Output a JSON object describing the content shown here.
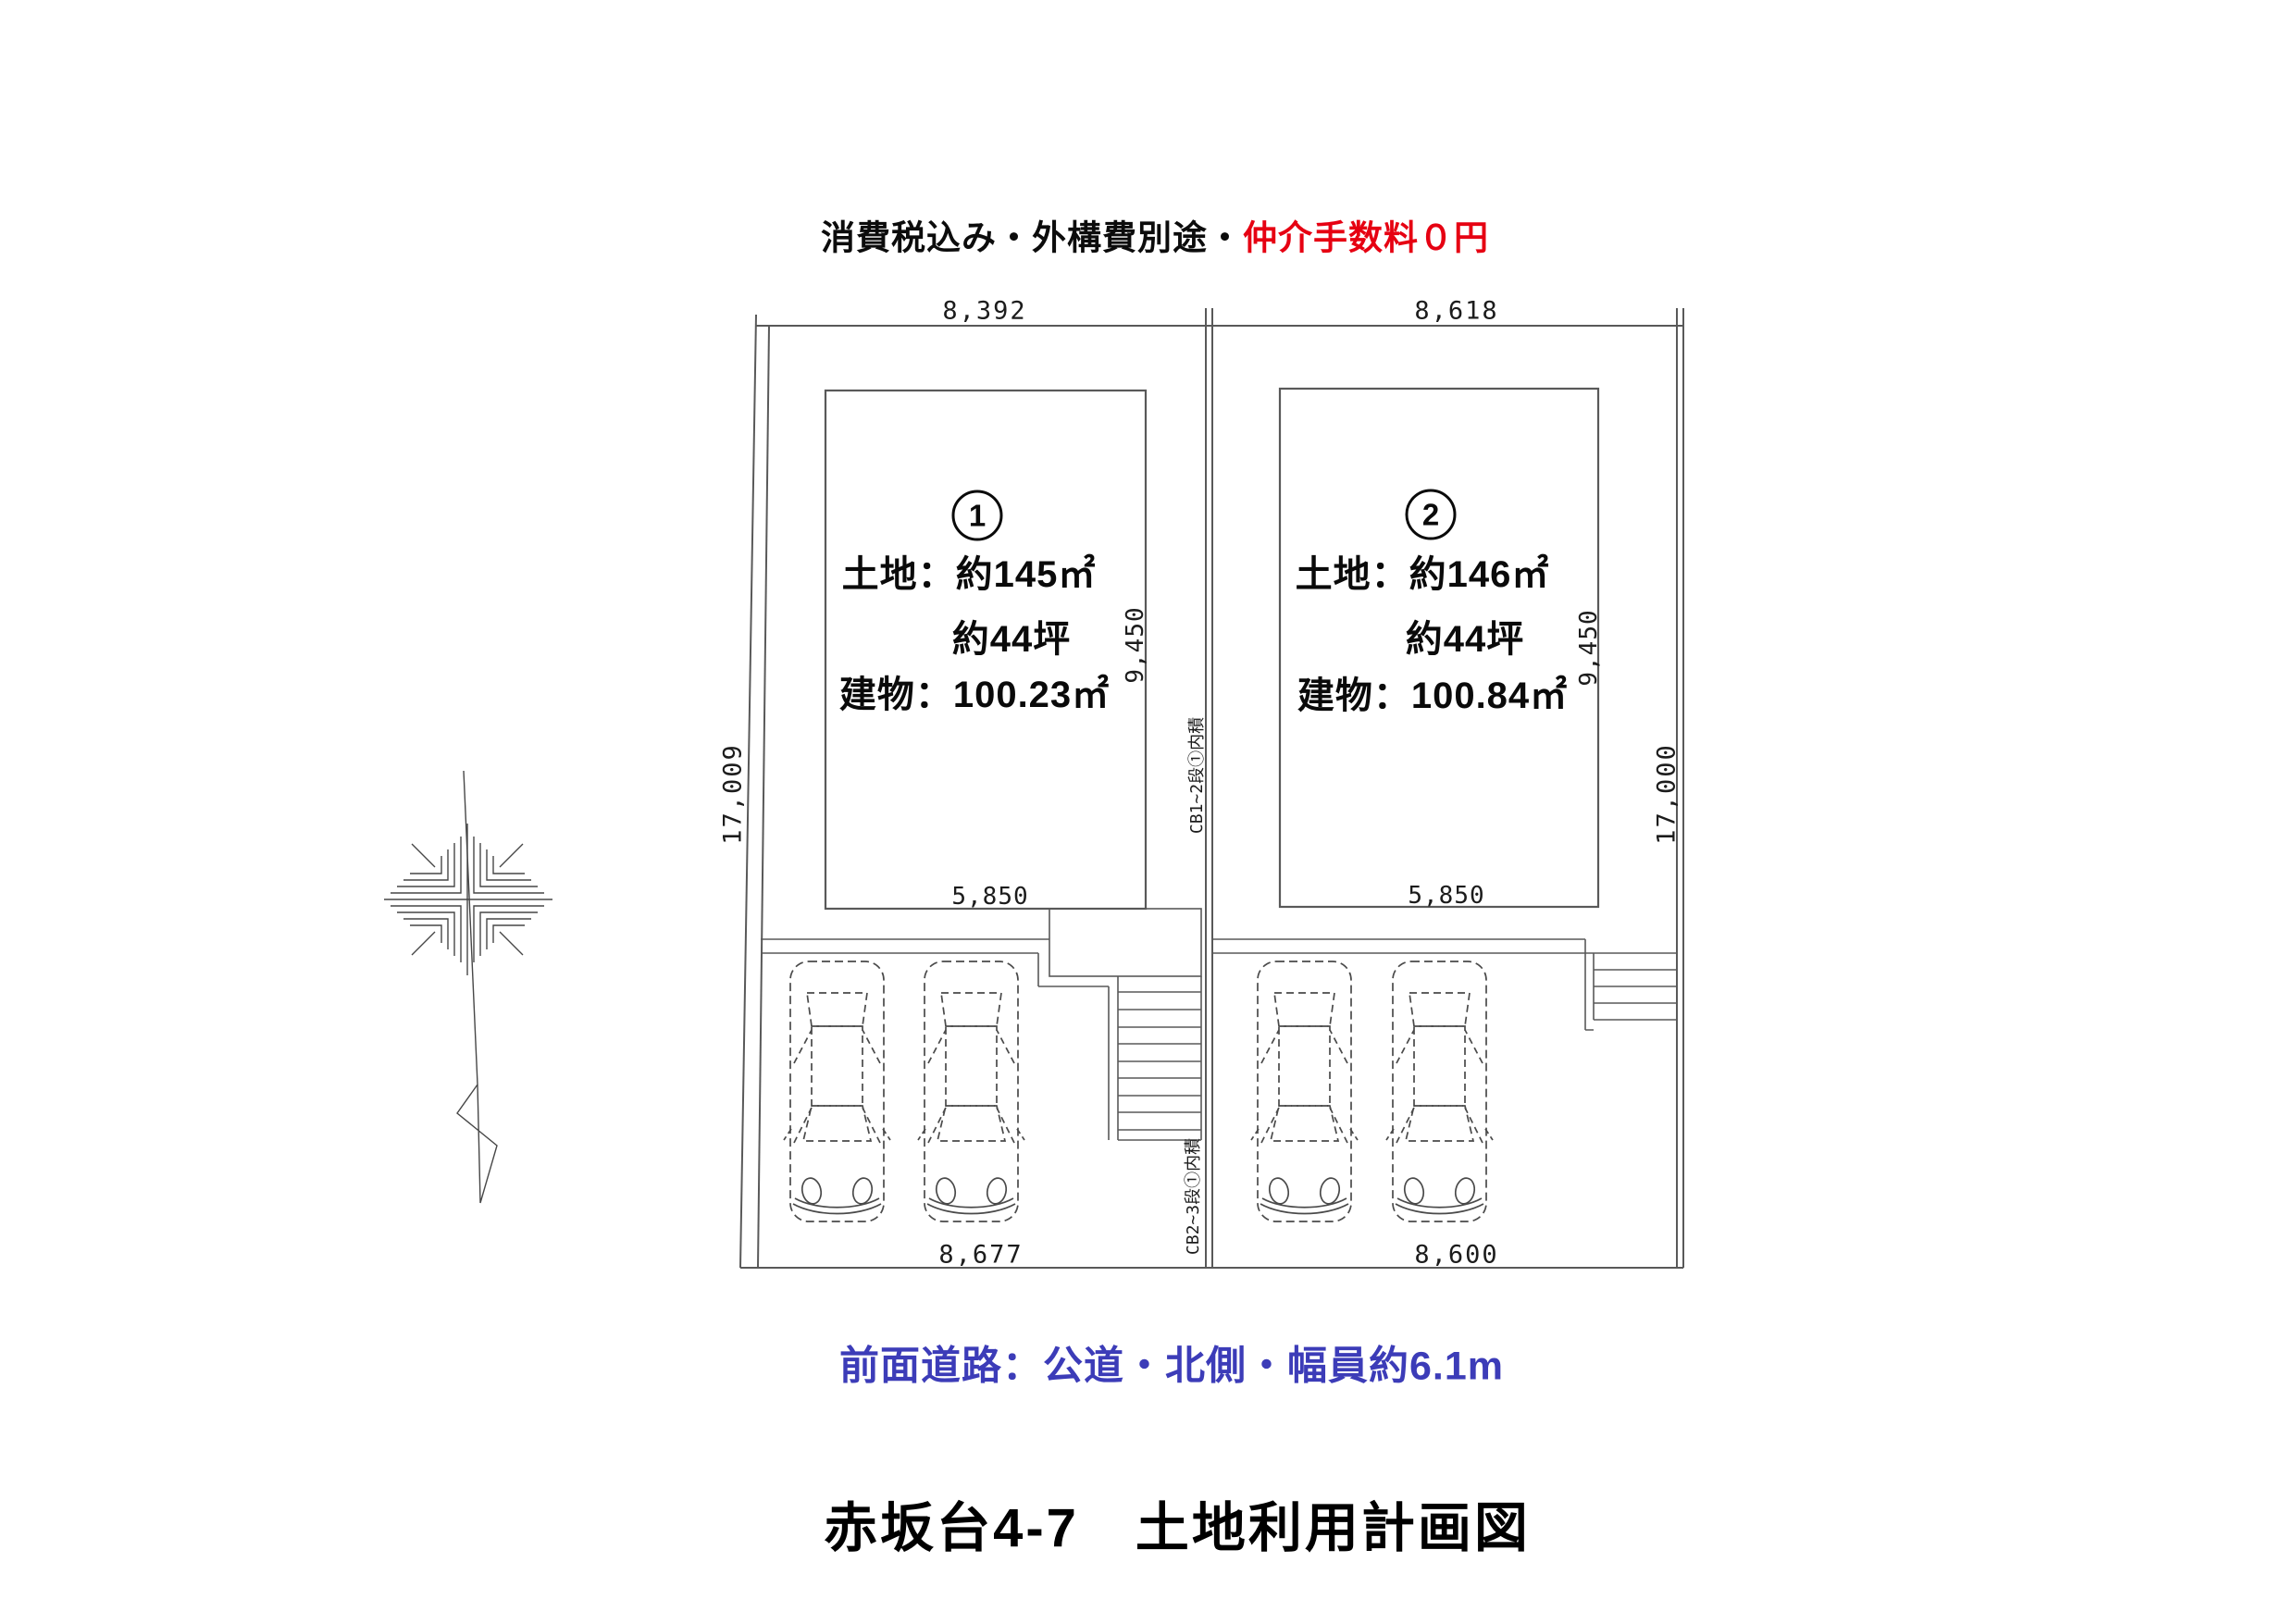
{
  "page": {
    "subtitle": {
      "black": "消費税込み・外構費別途・",
      "red": "仲介手数料０円"
    },
    "road_note": "前面道路：公道・北側・幅員約6.1m",
    "title": "赤坂台4-7　土地利用計画図"
  },
  "site": {
    "dimensions": {
      "top_left": "8,392",
      "top_right": "8,618",
      "side_left": "17,009",
      "side_right": "17,000",
      "bottom_left": "8,677",
      "bottom_right": "8,600"
    },
    "lots": [
      {
        "number": "1",
        "land_area": "土地：約145㎡",
        "land_tsubo": "約44坪",
        "building_area": "建物：100.23㎡",
        "building_depth": "9,450",
        "building_width": "5,850"
      },
      {
        "number": "2",
        "land_area": "土地：約146㎡",
        "land_tsubo": "約44坪",
        "building_area": "建物：100.84㎡",
        "building_depth": "9,450",
        "building_width": "5,850"
      }
    ],
    "block_wall_notes": [
      {
        "text": "CB1~2段①内積"
      },
      {
        "text": "CB2~3段①内積"
      }
    ]
  },
  "colors": {
    "red_accent": "#e60012",
    "blue_accent": "#3c3cb8",
    "line": "#595959"
  }
}
